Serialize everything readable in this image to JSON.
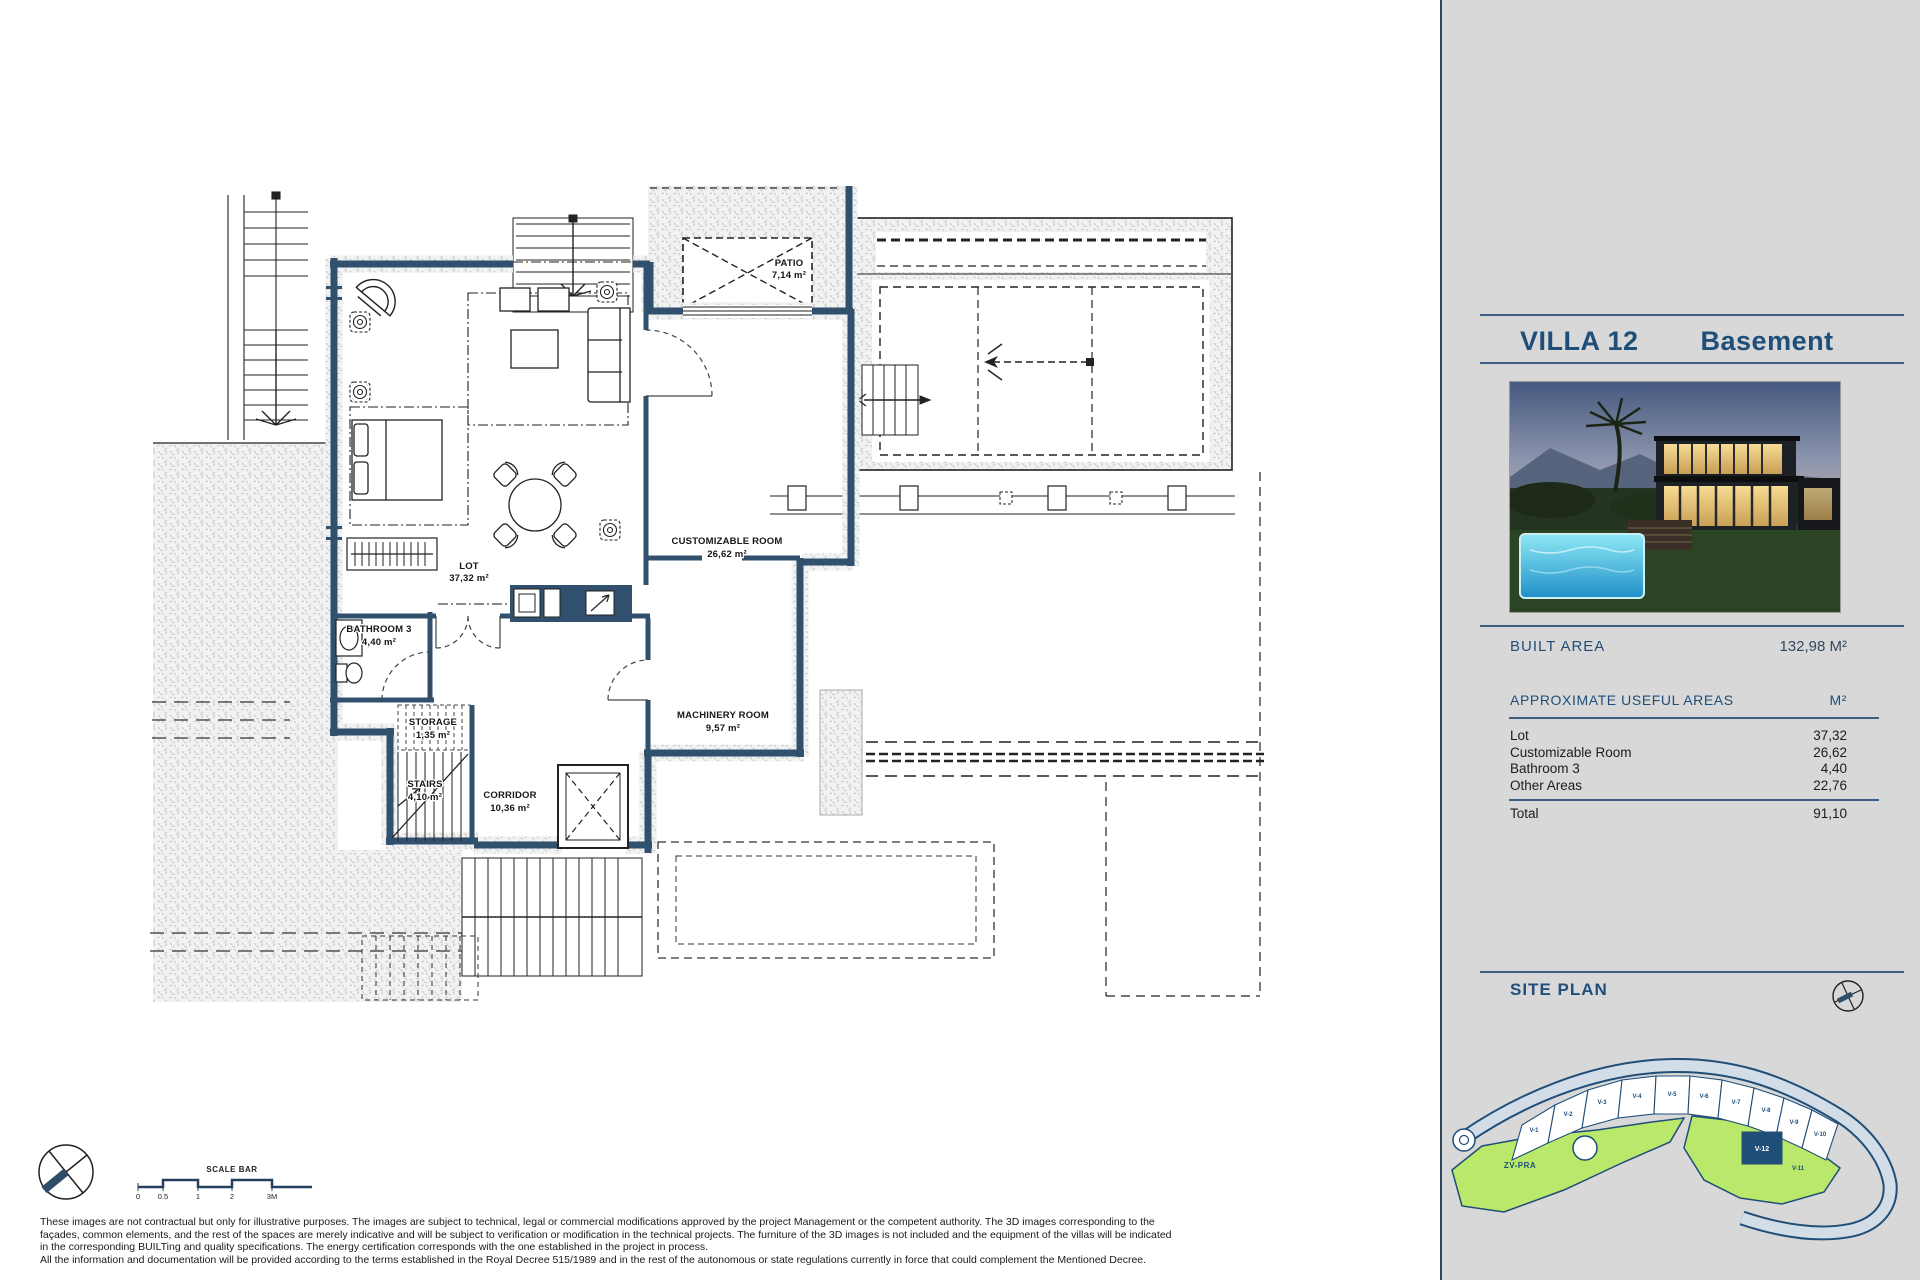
{
  "plan": {
    "rooms": [
      {
        "name": "PATIO",
        "area": "7,14 m²"
      },
      {
        "name": "LOT",
        "area": "37,32 m²"
      },
      {
        "name": "CUSTOMIZABLE ROOM",
        "area": "26,62 m²"
      },
      {
        "name": "BATHROOM 3",
        "area": "4,40 m²"
      },
      {
        "name": "STORAGE",
        "area": "1,35 m²"
      },
      {
        "name": "STAIRS",
        "area": "4,10 m²"
      },
      {
        "name": "CORRIDOR",
        "area": "10,36 m²"
      },
      {
        "name": "MACHINERY ROOM",
        "area": "9,57 m²"
      }
    ],
    "scale_bar": {
      "label": "SCALE BAR",
      "ticks": [
        "0",
        "0.5",
        "1",
        "2",
        "3M"
      ]
    },
    "disclaimer": [
      "These images are not contractual but only for illustrative purposes. The images are subject to technical, legal or commercial modifications approved by the project Management or the competent authority. The 3D images corresponding to the",
      "façades, common elements, and the rest of the spaces are merely indicative and will be subject to verification or modification in the technical projects. The furniture of the 3D images is not included and the equipment of the villas will be indicated",
      "in the corresponding BUILTing and quality specifications. The energy certification corresponds with the one established in the project in process.",
      "All the information and documentation will be provided according to the terms established in the Royal Decree 515/1989 and in the rest of the autonomous or state regulations currently in force that could complement the Mentioned Decree."
    ]
  },
  "sidebar": {
    "title": "VILLA 12",
    "subtitle": "Basement",
    "built_area_label": "BUILT AREA",
    "built_area_value": "132,98 M²",
    "useful_areas": {
      "heading": "APPROXIMATE USEFUL AREAS",
      "unit": "M²",
      "rows": [
        {
          "label": "Lot",
          "value": "37,32"
        },
        {
          "label": "Customizable Room",
          "value": "26,62"
        },
        {
          "label": "Bathroom 3",
          "value": "4,40"
        },
        {
          "label": "Other Areas",
          "value": "22,76"
        }
      ],
      "total_label": "Total",
      "total_value": "91,10"
    },
    "site_plan": {
      "heading": "SITE PLAN",
      "green_area_label": "ZV-PRA",
      "lots": [
        "V-1",
        "V-2",
        "V-3",
        "V-4",
        "V-5",
        "V-6",
        "V-7",
        "V-8",
        "V-9",
        "V-10",
        "V-11",
        "V-12"
      ],
      "highlighted_lot": "V-12"
    },
    "colors": {
      "accent_navy": "#1f4e79",
      "wall_navy": "#31506e",
      "green": "#b9e86a",
      "road": "#d3dde8"
    }
  }
}
